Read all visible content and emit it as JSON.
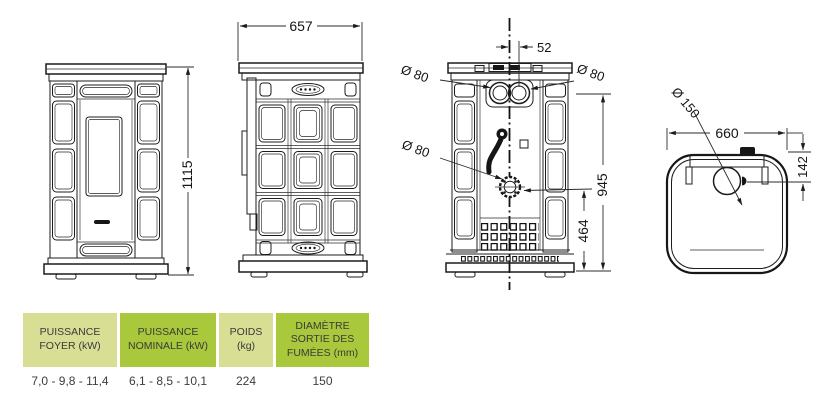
{
  "drawing": {
    "dims": {
      "front_height": "1115",
      "side_depth": "657",
      "back_pipe_offset": "52",
      "back_pipe_left_dia": "Ø 80",
      "back_pipe_right_dia": "Ø 80",
      "back_outlet_dia": "Ø 80",
      "back_pipe_height": "945",
      "back_outlet_height": "464",
      "top_flue_dia": "Ø 150",
      "top_width": "660",
      "top_flue_offset": "142"
    }
  },
  "table": {
    "headers": [
      {
        "label": "PUISSANCE FOYER (kW)",
        "tone": "light"
      },
      {
        "label": "PUISSANCE NOMINALE (kW)",
        "tone": "dark"
      },
      {
        "label": "POIDS (kg)",
        "tone": "light"
      },
      {
        "label": "DIAMÈTRE SORTIE DES FUMÉES (mm)",
        "tone": "dark"
      }
    ],
    "values": [
      "7,0 - 9,8 - 11,4",
      "6,1 - 8,5 - 10,1",
      "224",
      "150"
    ]
  },
  "colors": {
    "header_light": "#d8df94",
    "header_dark": "#a9c83c",
    "header_text": "#3a3a3a",
    "line": "#1c1c1c",
    "background": "#ffffff"
  }
}
